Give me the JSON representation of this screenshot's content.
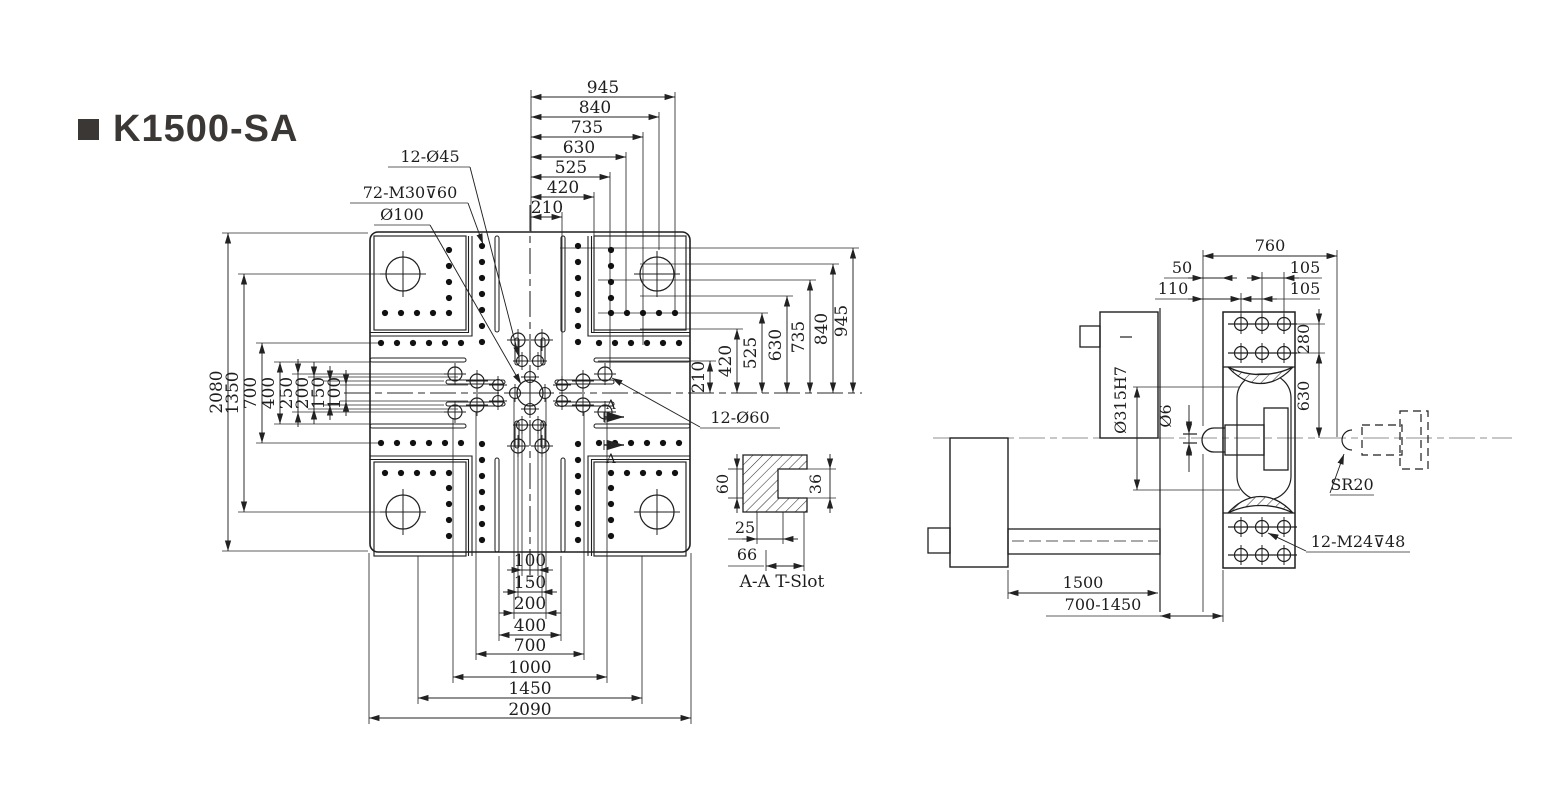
{
  "title": {
    "model": "K1500-SA"
  },
  "front_view": {
    "callouts": {
      "holes45": "12-Ø45",
      "tapped": "72-M30⊽60",
      "center_bore": "Ø100",
      "holes60": "12-Ø60",
      "section_a": "A"
    },
    "top_dims": [
      "945",
      "840",
      "735",
      "630",
      "525",
      "420",
      "210"
    ],
    "left_dims": [
      "2080",
      "1350",
      "700",
      "400",
      "250",
      "200",
      "150",
      "100"
    ],
    "right_dims": [
      "210",
      "420",
      "525",
      "630",
      "735",
      "840",
      "945"
    ],
    "bottom_dims": [
      "100",
      "150",
      "200",
      "400",
      "700",
      "1000",
      "1450",
      "2090"
    ]
  },
  "tslot": {
    "caption": "A-A T-Slot",
    "depth": "60",
    "lip": "25",
    "width": "66",
    "opening": "36"
  },
  "side_view": {
    "overall": "760",
    "nozzle_offset": "50",
    "edge_offset": "110",
    "pitch_top": "105",
    "pitch_bottom": "105",
    "row_gap": "280",
    "to_center": "630",
    "locating_bore": "Ø315H7",
    "orifice": "Ø6",
    "sphere_radius": "SR20",
    "tapped": "12-M24⊽48",
    "carriage_stroke": "1500",
    "mold_height_range": "700-1450"
  },
  "colors": {
    "line": "#222222",
    "centerline": "#8f8f8f",
    "title": "#3b3735",
    "bg": "#ffffff"
  }
}
